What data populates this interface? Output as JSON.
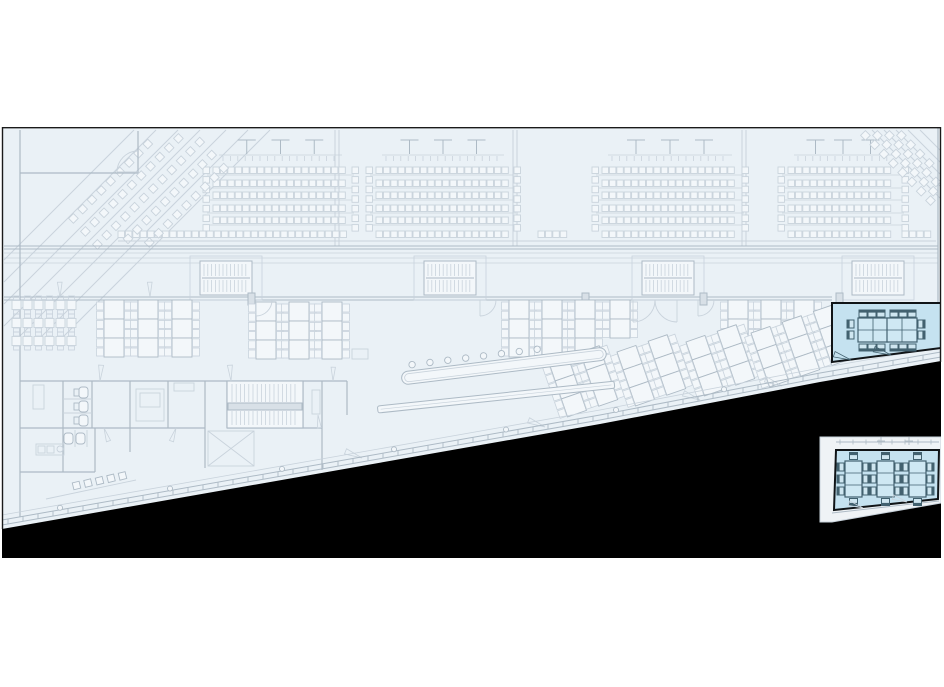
{
  "title": "floor-plan-view",
  "colors": {
    "page_bg": "#ffffff",
    "plan_bg": "#eaf1f6",
    "plan_border": "#1a1a1a",
    "line_light": "#c9d3dc",
    "line_mid": "#adbac5",
    "line_dark": "#93a3b0",
    "fill_white": "#f3f7fa",
    "landing_fill": "#d8e0e7",
    "void": "#000000",
    "room_fill": "#c5e2f0",
    "room_stroke": "#101417",
    "table_fill": "#cfe8f3",
    "furn_stroke": "#42616f",
    "furn_fill": "#a9cddd",
    "chair_seat": "#cfe6f0",
    "inset_frame_fill": "#eff3f6"
  },
  "plan": {
    "x": 2,
    "y": 127,
    "w": 939,
    "h": 431
  },
  "void": {
    "edge": [
      [
        2,
        529
      ],
      [
        350,
        468
      ],
      [
        600,
        424
      ],
      [
        820,
        382
      ],
      [
        941,
        361
      ]
    ],
    "bottom": 558
  },
  "facade": {
    "offsets": [
      -4,
      -9
    ],
    "light_offset": -14,
    "tick_step": 15,
    "column_xs": [
      60,
      170,
      282,
      394,
      506,
      616,
      724
    ]
  },
  "terraces": {
    "left": [
      [
        4,
        260,
        134,
        130
      ],
      [
        4,
        282,
        156,
        130
      ],
      [
        4,
        304,
        178,
        130
      ],
      [
        4,
        326,
        200,
        130
      ],
      [
        12,
        344,
        226,
        130
      ],
      [
        34,
        344,
        248,
        130
      ],
      [
        56,
        344,
        270,
        130
      ]
    ],
    "right": [
      [
        872,
        130,
        940,
        198
      ],
      [
        884,
        130,
        940,
        186
      ],
      [
        896,
        130,
        940,
        174
      ],
      [
        908,
        130,
        940,
        162
      ],
      [
        920,
        130,
        940,
        150
      ]
    ]
  },
  "auditorium": {
    "rows_y": [
      167,
      180,
      192,
      205,
      217
    ],
    "seat": 6.5,
    "pitch": 7.4,
    "line_offset": 8,
    "blocks": [
      [
        213,
        348
      ],
      [
        376,
        510
      ],
      [
        602,
        738
      ],
      [
        788,
        898
      ]
    ],
    "band": {
      "y": 231,
      "segments": [
        [
          118,
          348
        ],
        [
          376,
          510
        ],
        [
          538,
          572
        ],
        [
          602,
          738
        ],
        [
          788,
          898
        ],
        [
          902,
          934
        ]
      ]
    },
    "lectern": {
      "y_top": 140,
      "y_bot": 154,
      "line_y": 155,
      "tick_y1": 156,
      "tick_y2": 161,
      "fracs": [
        0.25,
        0.5,
        0.75
      ]
    },
    "strip_step": 9.6,
    "strip_y1": 167,
    "strip_y2": 232
  },
  "corner_left": {
    "origins": [
      [
        70,
        215
      ],
      [
        82,
        228
      ],
      [
        94,
        241
      ],
      [
        106,
        254
      ],
      [
        118,
        267
      ]
    ],
    "step": [
      9.3,
      -9.3
    ],
    "count": 12,
    "ymin": 133,
    "ymax": 244,
    "seat": 6.8
  },
  "corner_right": {
    "origins": [
      [
        898,
        132
      ],
      [
        886,
        132
      ],
      [
        874,
        132
      ],
      [
        862,
        132
      ]
    ],
    "step": [
      9.3,
      9.3
    ],
    "count": 9,
    "xmax": 934,
    "ymax": 212,
    "seat": 6.8
  },
  "aisles": {
    "xs": [
      335,
      339,
      513,
      517,
      742,
      746
    ],
    "y1": 130,
    "y2": 246
  },
  "corridor": {
    "wall_top_y": [
      246,
      249
    ],
    "wall_bot_y": [
      297,
      300
    ],
    "wall_x1": 4,
    "wall_x2": 832,
    "floor_lines_y": [
      253,
      258,
      263
    ],
    "stairs": [
      [
        200,
        261
      ],
      [
        424,
        261
      ],
      [
        642,
        261
      ],
      [
        852,
        261
      ]
    ],
    "stair_w": 52,
    "stair_h": 34
  },
  "walls_mid": [
    [
      20,
      130,
      20,
      517
    ],
    [
      938,
      128,
      938,
      303
    ],
    [
      20,
      173,
      138,
      173
    ],
    [
      138,
      131,
      138,
      173
    ],
    [
      20,
      381,
      347,
      381
    ],
    [
      63,
      381,
      63,
      428
    ],
    [
      92,
      381,
      92,
      428
    ],
    [
      130,
      381,
      130,
      428
    ],
    [
      168,
      381,
      168,
      428
    ],
    [
      205,
      381,
      205,
      468
    ],
    [
      227,
      381,
      227,
      428
    ],
    [
      303,
      381,
      303,
      428
    ],
    [
      322,
      381,
      322,
      470
    ],
    [
      347,
      381,
      347,
      415
    ],
    [
      20,
      428,
      205,
      428
    ],
    [
      227,
      428,
      322,
      428
    ],
    [
      63,
      428,
      63,
      472
    ],
    [
      95,
      428,
      95,
      472
    ],
    [
      20,
      472,
      95,
      472
    ],
    [
      130,
      428,
      130,
      452
    ]
  ],
  "walls_light": [
    [
      63,
      399,
      92,
      399
    ],
    [
      63,
      413,
      92,
      413
    ],
    [
      75,
      430,
      75,
      447
    ],
    [
      87,
      430,
      87,
      447
    ],
    [
      118,
      241,
      936,
      241
    ]
  ],
  "rect_light": [
    [
      208,
      431,
      46,
      35
    ],
    [
      136,
      389,
      28,
      32
    ],
    [
      140,
      393,
      20,
      14
    ],
    [
      33,
      385,
      11,
      24
    ],
    [
      36,
      444,
      28,
      11
    ],
    [
      38,
      446,
      7,
      7
    ],
    [
      47,
      446,
      7,
      7
    ],
    [
      174,
      383,
      20,
      8
    ],
    [
      324,
      349,
      16,
      10
    ],
    [
      352,
      349,
      16,
      10
    ],
    [
      312,
      390,
      8,
      24
    ]
  ],
  "diag_light": [
    [
      208,
      431,
      254,
      466
    ],
    [
      254,
      431,
      208,
      466
    ],
    [
      238,
      424,
      292,
      386
    ],
    [
      242,
      426,
      296,
      388
    ],
    [
      46,
      499,
      136,
      480
    ]
  ],
  "circles_light": [
    [
      60,
      449,
      3
    ]
  ],
  "columns": {
    "xs": [
      248,
      582,
      700,
      836
    ],
    "y": 293,
    "w": 7,
    "h": 12
  },
  "desk_clusters": [
    {
      "x": 104,
      "y": 300,
      "cols": 3,
      "gap": 34,
      "tables": 3,
      "rot": 0
    },
    {
      "x": 256,
      "y": 302,
      "cols": 3,
      "gap": 33,
      "tables": 3,
      "rot": 0
    },
    {
      "x": 509,
      "y": 300,
      "cols": 3,
      "gap": 33,
      "tables": 3,
      "rot": 0
    },
    {
      "x": 610,
      "y": 300,
      "cols": 1,
      "gap": 0,
      "tables": 2,
      "rot": 0
    },
    {
      "x": 728,
      "y": 300,
      "cols": 3,
      "gap": 33,
      "tables": 3,
      "rot": 0
    },
    {
      "x": 549,
      "y": 363,
      "cols": 2,
      "gap": 33,
      "tables": 3,
      "rot": -19
    },
    {
      "x": 617,
      "y": 352,
      "cols": 2,
      "gap": 33,
      "tables": 3,
      "rot": -19
    },
    {
      "x": 686,
      "y": 342,
      "cols": 2,
      "gap": 33,
      "tables": 3,
      "rot": -19
    },
    {
      "x": 751,
      "y": 333,
      "cols": 3,
      "gap": 33,
      "tables": 3,
      "rot": -19
    }
  ],
  "desk_geom": {
    "table_w": 20,
    "table_h": 19,
    "chair_w": 7,
    "chair_h": 8,
    "chair_step": 9.2
  },
  "table_grid": {
    "x0": 12,
    "rows_y": [
      296,
      314,
      332
    ],
    "cols": 6,
    "cell": 11
  },
  "counter": {
    "rot": -7,
    "cx": 402,
    "cy": 381,
    "outer": [
      402,
      372,
      206,
      13
    ],
    "inner": [
      405,
      374.5,
      200,
      8
    ],
    "stools": {
      "cy": 366,
      "cx0": 414,
      "step": 18,
      "n": 8,
      "r": 3.2
    },
    "lower": {
      "rot": -6,
      "cx": 378,
      "cy": 412,
      "rect": [
        378,
        406,
        238,
        7
      ]
    }
  },
  "toilets": {
    "upper": [
      [
        74,
        386
      ],
      [
        74,
        400
      ],
      [
        74,
        414
      ]
    ],
    "lower": [
      [
        64,
        432
      ],
      [
        76,
        432
      ]
    ]
  },
  "stair_main": {
    "x": 227,
    "y": 381,
    "w": 76,
    "h": 47,
    "landing_y": 403
  },
  "chair_row": {
    "x0": 73,
    "y0": 482,
    "dx": 11.5,
    "dy": -2.4,
    "n": 5,
    "rot": -14,
    "size": 7
  },
  "doors_wedge": [
    [
      100,
      381,
      -95,
      -77,
      16
    ],
    [
      231,
      381,
      -103,
      -85,
      16
    ],
    [
      333,
      381,
      -98,
      -80,
      14
    ],
    [
      104,
      428,
      62,
      80,
      14
    ],
    [
      176,
      428,
      100,
      118,
      14
    ],
    [
      318,
      415,
      75,
      93,
      13
    ],
    [
      60,
      297,
      -100,
      -82,
      15
    ],
    [
      150,
      297,
      -100,
      -82,
      15
    ],
    [
      362,
      458,
      193,
      211,
      18
    ],
    [
      545,
      427,
      193,
      211,
      18
    ],
    [
      700,
      400,
      193,
      211,
      18
    ],
    [
      782,
      386,
      193,
      211,
      18
    ]
  ],
  "doors_arc": [
    [
      256,
      300,
      16,
      "dr"
    ],
    [
      480,
      300,
      16,
      "dr"
    ],
    [
      698,
      300,
      16,
      "dr"
    ],
    [
      633,
      300,
      22,
      "dr"
    ],
    [
      677,
      300,
      22,
      "dl"
    ],
    [
      138,
      172,
      21,
      "ul"
    ]
  ],
  "room_highlight": {
    "outline": [
      [
        832,
        303
      ],
      [
        941,
        303
      ],
      [
        941,
        348
      ],
      [
        832,
        362
      ]
    ],
    "tables": [
      [
        858,
        318,
        30,
        24
      ],
      [
        887,
        318,
        30,
        24
      ]
    ],
    "chairs_top": {
      "xs": [
        859,
        868,
        877,
        890,
        899,
        908
      ],
      "y": 310
    },
    "chairs_bottom_y": 344,
    "chair_w": 8,
    "chair_h": 7,
    "end_chairs": [
      [
        847,
        320
      ],
      [
        847,
        331
      ],
      [
        918,
        320
      ],
      [
        918,
        331
      ]
    ],
    "doors": [
      [
        851,
        360,
        -152,
        -170,
        18
      ],
      [
        891,
        355,
        -152,
        -170,
        18
      ]
    ]
  },
  "inset_room": {
    "frame": [
      [
        820,
        437
      ],
      [
        941,
        437
      ],
      [
        941,
        503
      ],
      [
        832,
        522
      ],
      [
        820,
        522
      ]
    ],
    "room": [
      [
        836,
        450
      ],
      [
        939,
        450
      ],
      [
        938,
        499
      ],
      [
        834,
        510
      ]
    ],
    "frame_line_top": [
      836,
      442,
      939,
      442
    ],
    "frame_line_bottom": [
      832,
      513,
      939,
      501
    ],
    "cross_marks": [
      [
        881,
        441
      ],
      [
        909,
        441
      ]
    ],
    "tables": {
      "xs": [
        845,
        877,
        909
      ],
      "y": 461,
      "w": 17,
      "h": 36
    },
    "side_chair_ys": [
      463,
      475,
      487
    ],
    "chair_w": 7,
    "chair_h": 8,
    "doors": [
      [
        863,
        508,
        -152,
        -170,
        15
      ],
      [
        907,
        502,
        -152,
        -170,
        15
      ]
    ]
  }
}
